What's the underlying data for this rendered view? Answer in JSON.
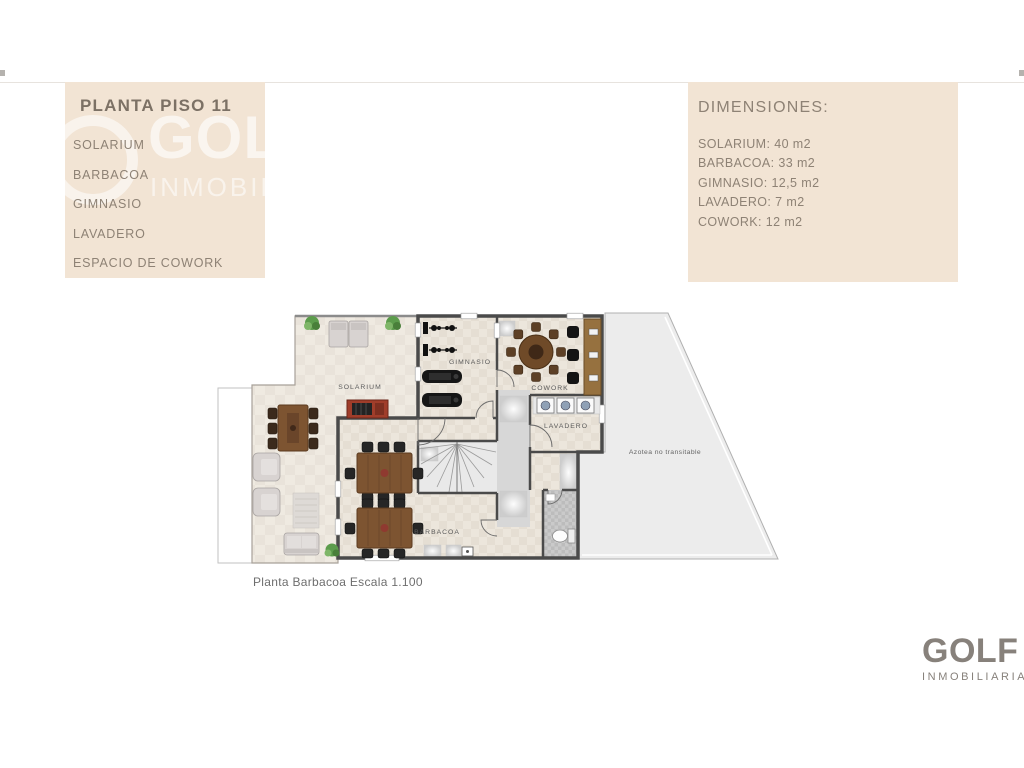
{
  "panels": {
    "left": {
      "title": "PLANTA PISO 11",
      "items": [
        "SOLARIUM",
        "BARBACOA",
        "GIMNASIO",
        "LAVADERO",
        "ESPACIO DE COWORK"
      ]
    },
    "dimensions": {
      "title": "DIMENSIONES:",
      "items": [
        "SOLARIUM: 40 m2",
        "BARBACOA: 33 m2",
        "GIMNASIO: 12,5 m2",
        "LAVADERO: 7 m2",
        "COWORK: 12 m2"
      ]
    }
  },
  "watermark": {
    "big": "GOLF",
    "small": "INMOBILIARIA"
  },
  "plan": {
    "labels": {
      "solarium": "SOLARIUM",
      "gimnasio": "GIMNASIO",
      "cowork": "COWORK",
      "lavadero": "LAVADERO",
      "barbacoa": "BARBACOA",
      "azotea": "Azotea no transitable"
    },
    "caption": "Planta Barbacoa Escala 1.100"
  },
  "brand": {
    "name": "GOLF",
    "tagline": "INMOBILIARIA"
  },
  "colors": {
    "panel_bg": "#f2e4d4",
    "panel_title": "#7c7165",
    "panel_text": "#8e8275",
    "wall": "#4a4a4a",
    "tile": "#e5ded3",
    "terrace_tile": "#e9e3da",
    "corridor": "#d7d7d7",
    "azotea": "#ececec",
    "wood": "#7d5431",
    "logo_gray": "#87817b"
  }
}
